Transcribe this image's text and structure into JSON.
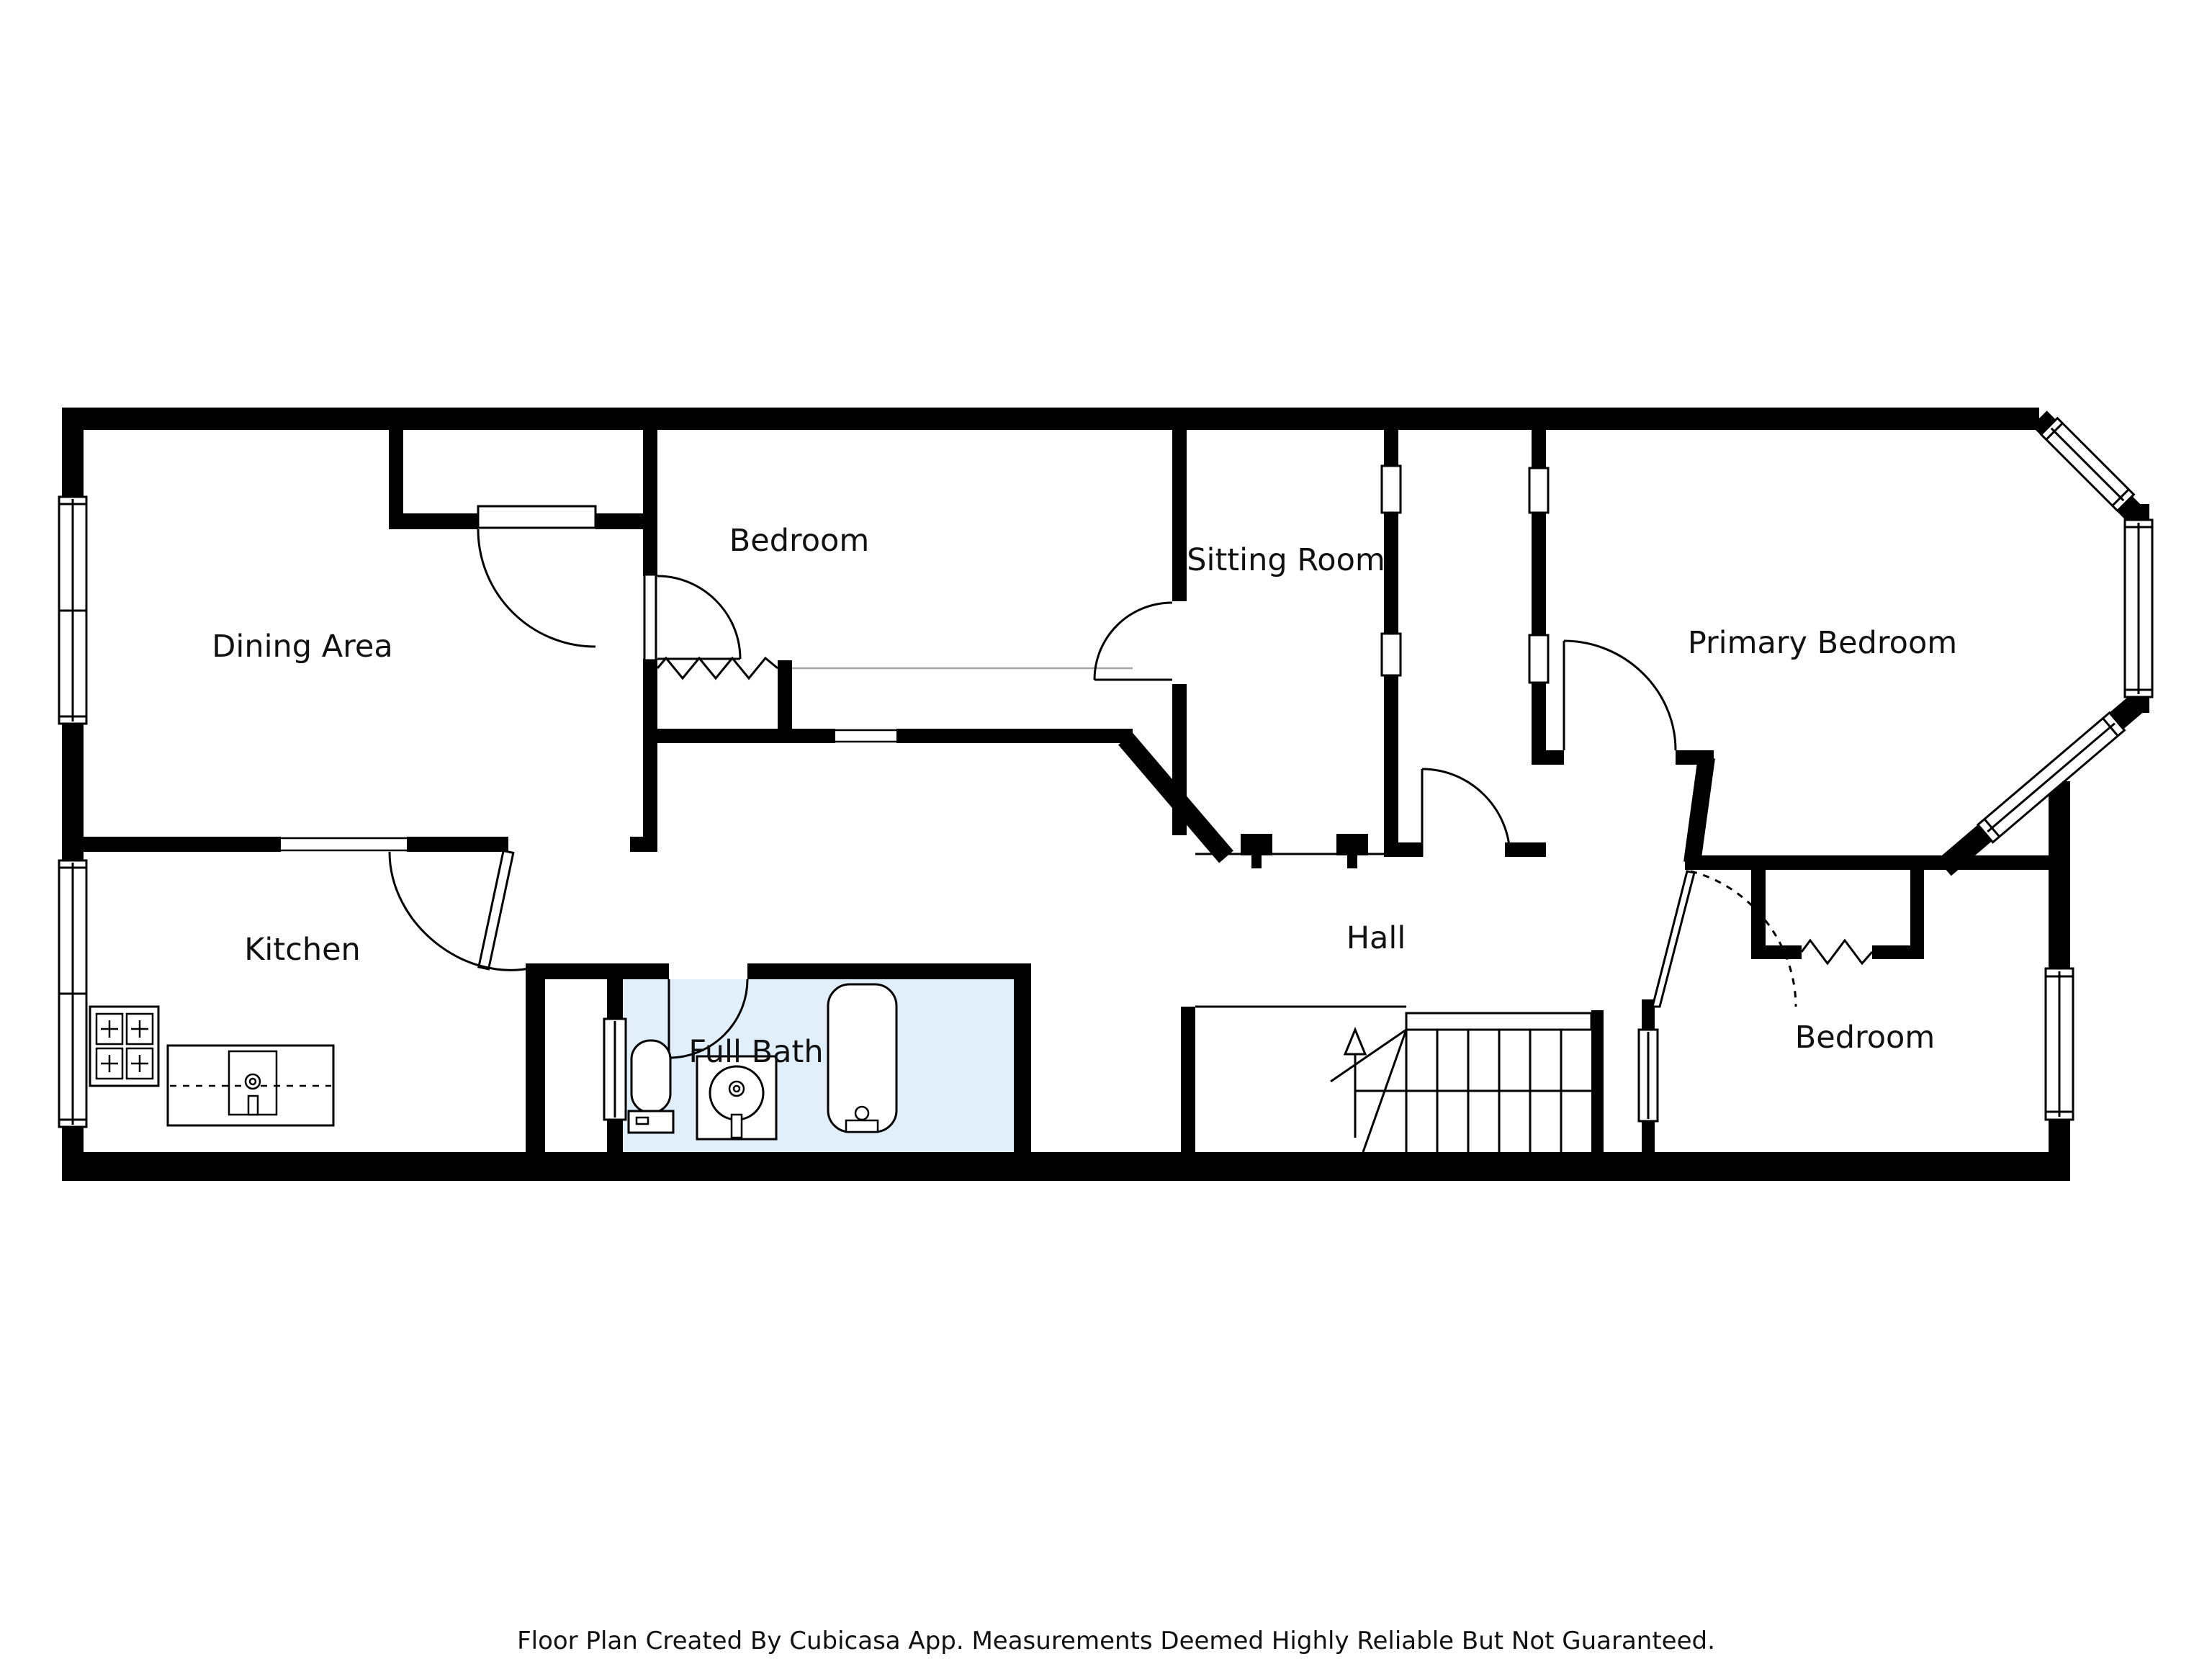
{
  "footer": {
    "text": "Floor Plan Created By Cubicasa App. Measurements Deemed Highly Reliable But Not Guaranteed."
  },
  "colors": {
    "wall": "#000000",
    "background": "#ffffff",
    "bath_fill": "#e1effa",
    "line": "#000000"
  },
  "rooms": {
    "dining": {
      "label": "Dining Area"
    },
    "bedroom_mid": {
      "label": "Bedroom"
    },
    "sitting": {
      "label": "Sitting Room"
    },
    "primary": {
      "label": "Primary Bedroom"
    },
    "kitchen": {
      "label": "Kitchen"
    },
    "bath": {
      "label": "Full Bath"
    },
    "hall": {
      "label": "Hall"
    },
    "bedroom_right": {
      "label": "Bedroom"
    }
  },
  "icons": {
    "stove": "stove-icon",
    "counter_sink": "kitchen-sink-icon",
    "toilet": "toilet-icon",
    "vanity_sink": "bathroom-sink-icon",
    "bathtub": "bathtub-icon",
    "stairs": "stairs-up-icon"
  }
}
